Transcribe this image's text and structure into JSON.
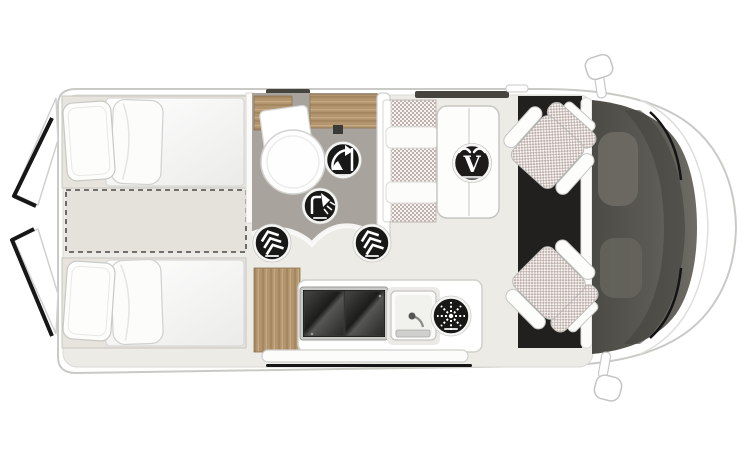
{
  "canvas": {
    "width": 742,
    "height": 451,
    "background": "#ffffff"
  },
  "vehicle": {
    "type": "campervan floor plan",
    "view": "top-down"
  },
  "colors": {
    "body_outline": "#c9c9c6",
    "interior_floor": "#ecebe5",
    "bathroom_floor": "#a8a49d",
    "wood_cabinet": "#b2956e",
    "mattress": "#e6e4dc",
    "cab_floor": "#21201e",
    "dashboard": "#55534e",
    "window_strip": "#45443e",
    "icon_background": "#181817",
    "icon_foreground": "#ffffff",
    "upholstery_check": "#beb0ac",
    "door_edge_black": "#171717"
  },
  "regions": {
    "rear_door_top": {
      "label": "open rear door"
    },
    "rear_door_bottom": {
      "label": "open rear door"
    },
    "bed_top": {
      "label": "single bed"
    },
    "bed_bottom": {
      "label": "single bed"
    },
    "bed_filler": {
      "label": "bed extension cushion"
    },
    "bathroom": {
      "label": "bathroom with round shower tray"
    },
    "overhead_cabinets": {
      "label": "overhead wood cabinets"
    },
    "kitchen": {
      "label": "kitchen unit"
    },
    "hob": {
      "label": "two-burner hob with glass cover"
    },
    "sink": {
      "label": "kitchen sink"
    },
    "dinette_bench": {
      "label": "dinette bench seat"
    },
    "dinette_table": {
      "label": "dinette table"
    },
    "cab": {
      "label": "driver cab"
    },
    "seat_passenger": {
      "label": "swivelled passenger seat"
    },
    "seat_driver": {
      "label": "swivelled driver seat"
    },
    "dashboard": {
      "label": "dashboard and windscreen"
    },
    "mirror_top": {
      "label": "side mirror"
    },
    "mirror_bottom": {
      "label": "side mirror"
    },
    "entry_step": {
      "label": "sliding-door entry step"
    },
    "window_bathroom": {
      "label": "window"
    },
    "window_dinette": {
      "label": "window"
    }
  },
  "icons": {
    "swivel_wall": {
      "name": "swivel-wall-icon",
      "shape": "curved-arrow-with-panel"
    },
    "shower": {
      "name": "shower-icon",
      "shape": "shower-head"
    },
    "feature_left": {
      "name": "chevron-feature-icon",
      "shape": "triple-chevron"
    },
    "feature_right": {
      "name": "chevron-feature-icon",
      "shape": "triple-chevron"
    },
    "fridge": {
      "name": "fridge-snowflake-icon",
      "shape": "dotted-snowflake"
    },
    "brand": {
      "name": "brand-v-logo-icon",
      "shape": "letter-V-with-horns",
      "letter": "V"
    }
  }
}
